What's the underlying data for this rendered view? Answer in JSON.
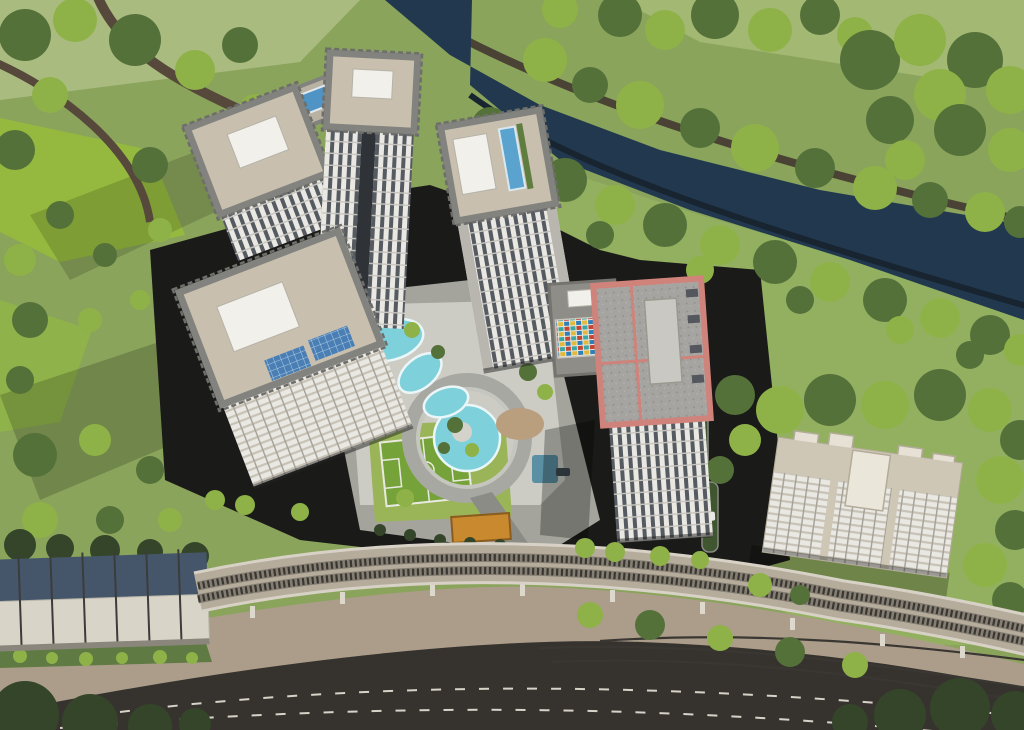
{
  "scene": {
    "type": "aerial-architectural-rendering",
    "description": "Bird's-eye 3D rendering of a riverside residential complex: five white high-rise towers with rooftop pools around an amenity courtyard (lazy-river pool, spiral walkway, basketball court), a red-trimmed tower with colorful kindergarten block, a cream mid-rise block to the east, a dark tree-lined canal crossing the upper area, and a curved elevated rail viaduct with a barrel-roof station above curved service and asphalt roads at the bottom.",
    "elements": [
      {
        "name": "river",
        "label": "canal with dark water"
      },
      {
        "name": "riverside-trees",
        "label": "tree rows on both banks"
      },
      {
        "name": "park-fields",
        "label": "green park fields west"
      },
      {
        "name": "tower-northwest-a",
        "label": "residential tower"
      },
      {
        "name": "tower-northwest-b",
        "label": "tall residential tower"
      },
      {
        "name": "rooftop-pools-podium",
        "label": "podium with two rooftop pools"
      },
      {
        "name": "tower-southwest",
        "label": "residential tower with solar panels"
      },
      {
        "name": "tower-center",
        "label": "tower with rooftop lap pool"
      },
      {
        "name": "tower-red-trim",
        "label": "tower with red parapet roof"
      },
      {
        "name": "kindergarten-block",
        "label": "low block with colorful facade"
      },
      {
        "name": "residential-block-east",
        "label": "cream mid-rise block"
      },
      {
        "name": "amenity-courtyard",
        "label": "pool deck courtyard"
      },
      {
        "name": "lazy-river-pool",
        "label": "meandering pool"
      },
      {
        "name": "round-pool",
        "label": "round pool with spiral walkway"
      },
      {
        "name": "basketball-court",
        "label": "green sports court"
      },
      {
        "name": "entrance-canopy",
        "label": "orange entrance canopy"
      },
      {
        "name": "metro-station",
        "label": "barrel-roof rail station"
      },
      {
        "name": "rail-viaduct",
        "label": "curved twin-track viaduct"
      },
      {
        "name": "service-road",
        "label": "tan curved road with tracks"
      },
      {
        "name": "main-road",
        "label": "dark asphalt road with dashed lanes"
      },
      {
        "name": "cars",
        "label": "small vehicles"
      }
    ]
  },
  "palette": {
    "grass": "#8aa45c",
    "grass_bright": "#95b93f",
    "grass_pale": "#aabb80",
    "grass_right": "#93b061",
    "grass_shadow": "#5b7140",
    "tree_light": "#8fb248",
    "tree_dark": "#55713a",
    "tree_deep": "#35452a",
    "river": "#21384e",
    "trail": "#56493b",
    "site_asphalt": "#1a1a18",
    "plaza": "#a4a49d",
    "pool_deck": "#d3d3cc",
    "pool_water": "#7ed0da",
    "lawn": "#9ab557",
    "court": "#76a339",
    "court_line": "#e9e9e1",
    "facade": "#e9e8e3",
    "facade_window": "#565b61",
    "parapet": "#82827e",
    "roof_deck": "#c8bfae",
    "roof_box": "#f2f0ea",
    "rooftop_pool": "#4f94c4",
    "solar": "#4a7fb5",
    "red_trim": "#cf837a",
    "red_roof": "#a6a4a0",
    "school_blue": "#2f7fb8",
    "school_yellow": "#e3b93c",
    "school_red": "#c44536",
    "school_teal": "#3aa8a0",
    "cream": "#d9d2c0",
    "cream_roof": "#cfc7b5",
    "station_glass": "#45566a",
    "station_body": "#d8d4c8",
    "viaduct": "#b5ac9c",
    "track": "#3a3733",
    "road_tan": "#ab9d8a",
    "road_asphalt": "#36332f",
    "lane_dash": "#d8d3c8",
    "canopy_orange": "#c9892e",
    "canopy_blue": "#5b8fa3",
    "car_white": "#e8e8e6"
  }
}
